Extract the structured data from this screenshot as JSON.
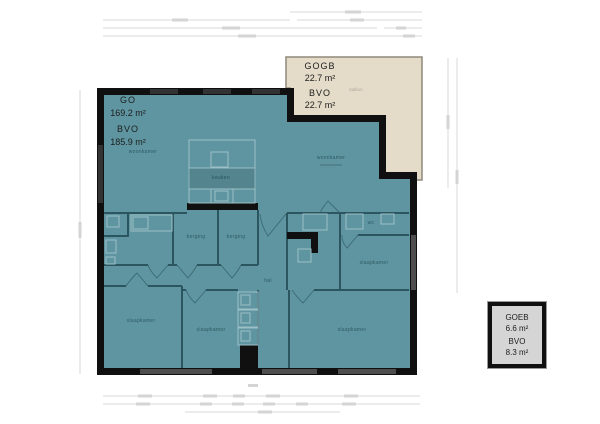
{
  "colors": {
    "floor": "#5E95A0",
    "wall": "#101010",
    "innerwall": "#2B5660",
    "fixture": "#9DBFC6",
    "door": "#35616D",
    "balcony_fill": "#E4DBC9",
    "balcony_border": "#8D897B",
    "storage_fill": "#D5D5D5",
    "dim": "#DADADA",
    "dimsmudge": "#D4D4D4",
    "label": "#1D1D1D",
    "room_label": "rgba(5,40,50,0.55)"
  },
  "units": {
    "main": {
      "l1": "GO",
      "l2": "169.2 m²",
      "l3": "BVO",
      "l4": "185.9 m²"
    },
    "balcony": {
      "l1": "GOGB",
      "l2": "22.7 m²",
      "l3": "BVO",
      "l4": "22.7 m²"
    },
    "storage": {
      "l1": "GOEB",
      "l2": "6.6 m²",
      "l3": "BVO",
      "l4": "8.3 m²"
    }
  },
  "rooms": {
    "living_left": "woonkamer",
    "living_right": "woonkamer",
    "kitchen": "keuken",
    "storage1": "berging",
    "storage2": "berging",
    "toilet": "wc",
    "bedroom_mid_right": "slaapkamer",
    "hall": "hal",
    "bedroom_bottom_left": "slaapkamer",
    "bedroom_bottom_center": "slaapkamer",
    "bedroom_bottom_right": "slaapkamer",
    "balcony": "balkon"
  }
}
